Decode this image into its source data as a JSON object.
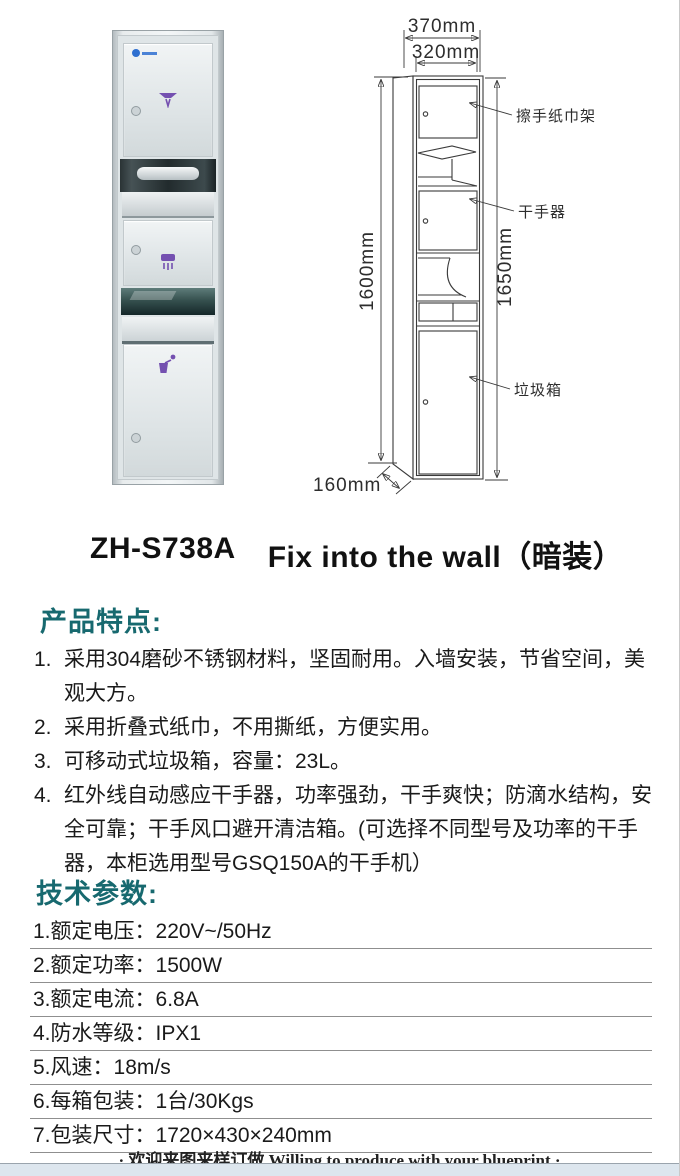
{
  "header": {
    "model": "ZH-S738A",
    "title": "Fix into the wall（暗装）"
  },
  "drawing": {
    "dimensions": {
      "outer_width": "370mm",
      "inner_width": "320mm",
      "left_height": "1600mm",
      "right_height": "1650mm",
      "depth": "160mm"
    },
    "labels": {
      "paper_rack": "擦手纸巾架",
      "hand_dryer": "干手器",
      "trash_bin": "垃圾箱"
    }
  },
  "features": {
    "heading": "产品特点:",
    "items": [
      {
        "num": "1.",
        "text": "采用304磨砂不锈钢材料，坚固耐用。入墙安装，节省空间，美观大方。"
      },
      {
        "num": "2.",
        "text": "采用折叠式纸巾，不用撕纸，方便实用。"
      },
      {
        "num": "3.",
        "text": "可移动式垃圾箱，容量：23L。"
      },
      {
        "num": "4.",
        "text": "红外线自动感应干手器，功率强劲，干手爽快；防滴水结构，安全可靠；干手风口避开清洁箱。(可选择不同型号及功率的干手器，本柜选用型号GSQ150A的干手机）"
      }
    ]
  },
  "specs": {
    "heading": "技术参数:",
    "rows": [
      {
        "text": "1.额定电压：220V~/50Hz"
      },
      {
        "text": "2.额定功率：1500W"
      },
      {
        "text": "3.额定电流：6.8A"
      },
      {
        "text": "4.防水等级：IPX1"
      },
      {
        "text": "5.风速：18m/s"
      },
      {
        "text": "6.每箱包装：1台/30Kgs"
      },
      {
        "text": "7.包装尺寸：1720×430×240mm"
      }
    ]
  },
  "footer": {
    "text": "· 欢迎来图来样订做  Willing to produce with your blueprint ·"
  },
  "colors": {
    "accent_teal": "#17696f",
    "footer_bar": "#dde6ee",
    "icon_purple": "#7450b0",
    "logo_blue": "#2e6fd0",
    "glass_teal": "#36514f"
  }
}
